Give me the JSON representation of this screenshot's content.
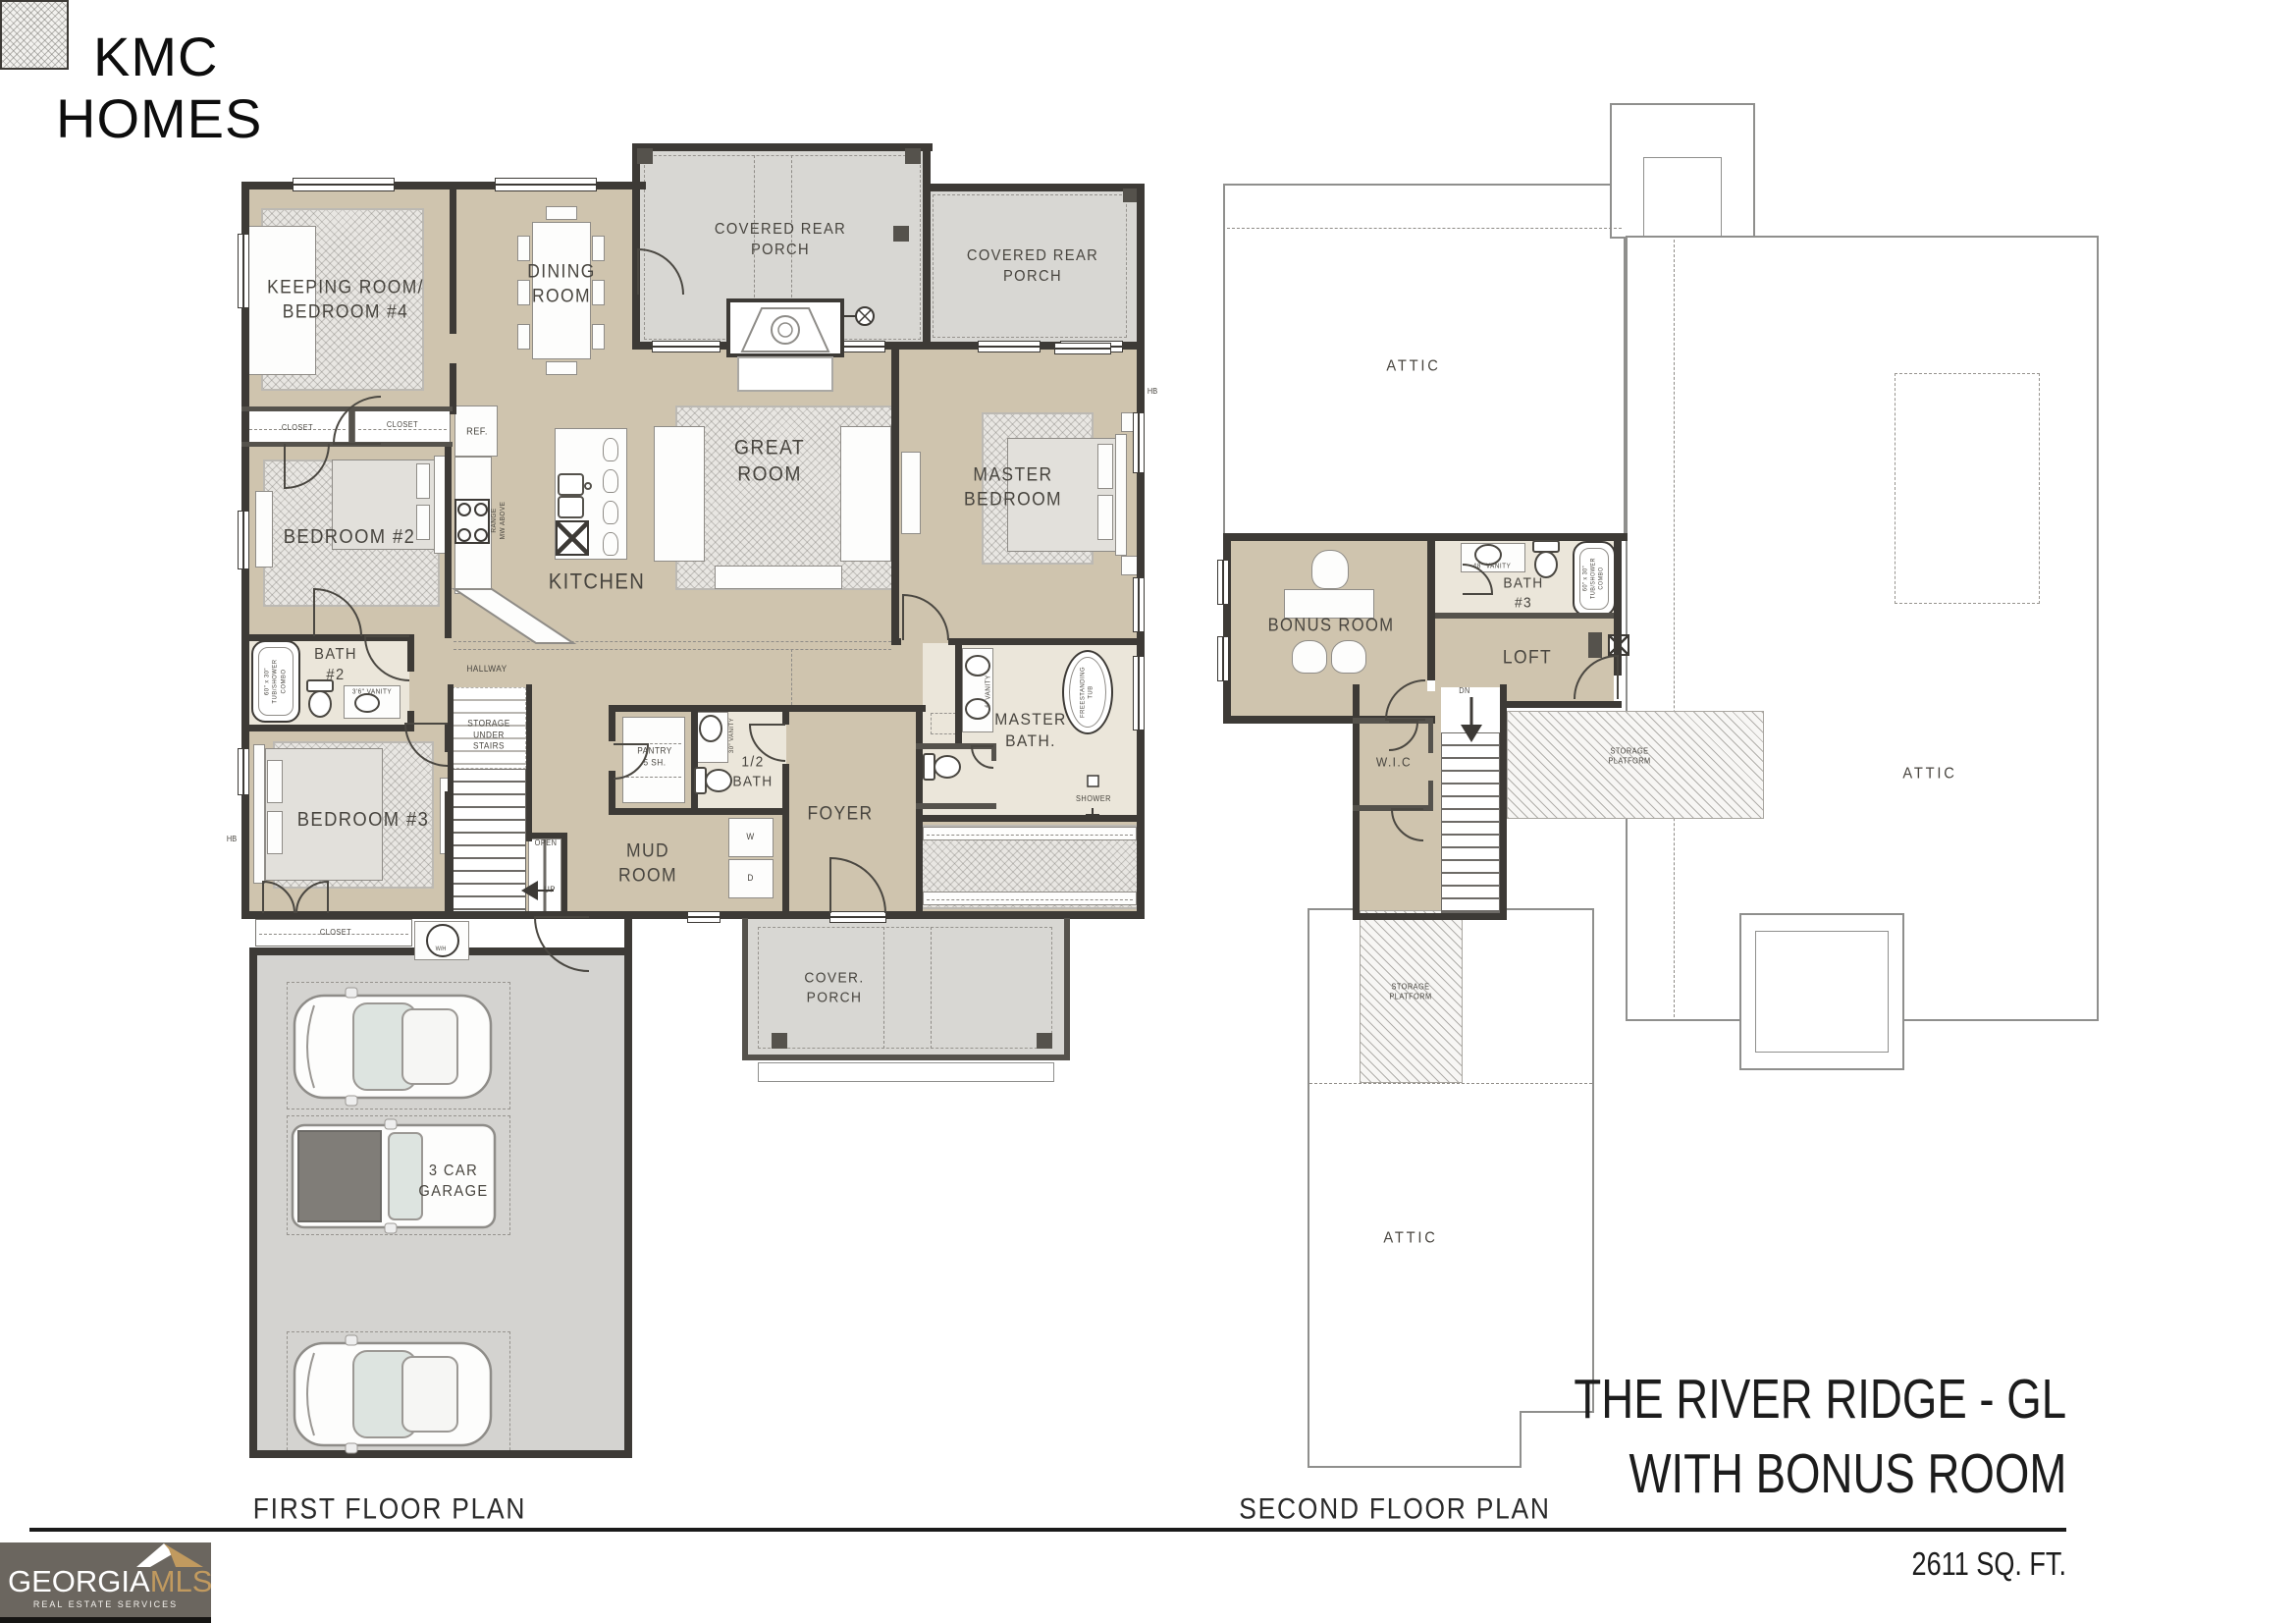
{
  "branding": {
    "line1": "KMC",
    "line2": "HOMES"
  },
  "footer": {
    "first_plan": "FIRST FLOOR PLAN",
    "second_plan": "SECOND FLOOR PLAN",
    "title_line1": "THE RIVER RIDGE - GL",
    "title_line2": "WITH BONUS ROOM",
    "sqft": "2611 SQ. FT."
  },
  "logo": {
    "georgia": "GEORGIA",
    "mls": "MLS",
    "tagline": "REAL ESTATE SERVICES"
  },
  "colors": {
    "wall": "#3d3a36",
    "room_tan": "#cfc4ae",
    "porch_gray": "#d8d7d3",
    "bath_cream": "#ebe6da",
    "logo_bg": "#6b665f",
    "logo_gold": "#c19a5f"
  },
  "ff": {
    "keeping": "KEEPING ROOM/\nBEDROOM #4",
    "dining": "DINING\nROOM",
    "covered_rear_porch": "COVERED REAR\nPORCH",
    "great": "GREAT\nROOM",
    "master_bedroom": "MASTER\nBEDROOM",
    "bedroom2": "BEDROOM #2",
    "bedroom3": "BEDROOM #3",
    "kitchen": "KITCHEN",
    "bath2": "BATH\n#2",
    "tub_combo": "60\" x 30\"\nTUB/SHOWER\nCOMBO",
    "vanity_36": "3'6\" VANITY",
    "closet": "CLOSET",
    "ref": "REF.",
    "range": "RANGE\nMW ABOVE",
    "hallway": "HALLWAY",
    "storage_under_stairs": "STORAGE\nUNDER\nSTAIRS",
    "open": "OPEN",
    "up": "UP",
    "pantry": "PANTRY\n5 SH.",
    "half_bath": "1/2\nBATH",
    "vanity_30": "30\" VANITY",
    "mud_room": "MUD\nROOM",
    "foyer": "FOYER",
    "master_bath": "MASTER\nBATH.",
    "freestanding_tub": "FREESTANDING\nTUB",
    "shower": "SHOWER",
    "vanity_6": "6' VANITY",
    "washer": "W",
    "dryer": "D",
    "water_heater": "W/H",
    "cover_porch": "COVER.\nPORCH",
    "garage": "3 CAR\nGARAGE",
    "hose_bib": "HB"
  },
  "sf": {
    "attic": "ATTIC",
    "bonus": "BONUS ROOM",
    "bath3": "BATH\n#3",
    "vanity_48": "48\" VANITY",
    "tub_combo": "60\" x 30\"\nTUB/SHOWER\nCOMBO",
    "loft": "LOFT",
    "wic": "W.I.C",
    "dn": "DN",
    "storage_platform": "STORAGE\nPLATFORM"
  }
}
